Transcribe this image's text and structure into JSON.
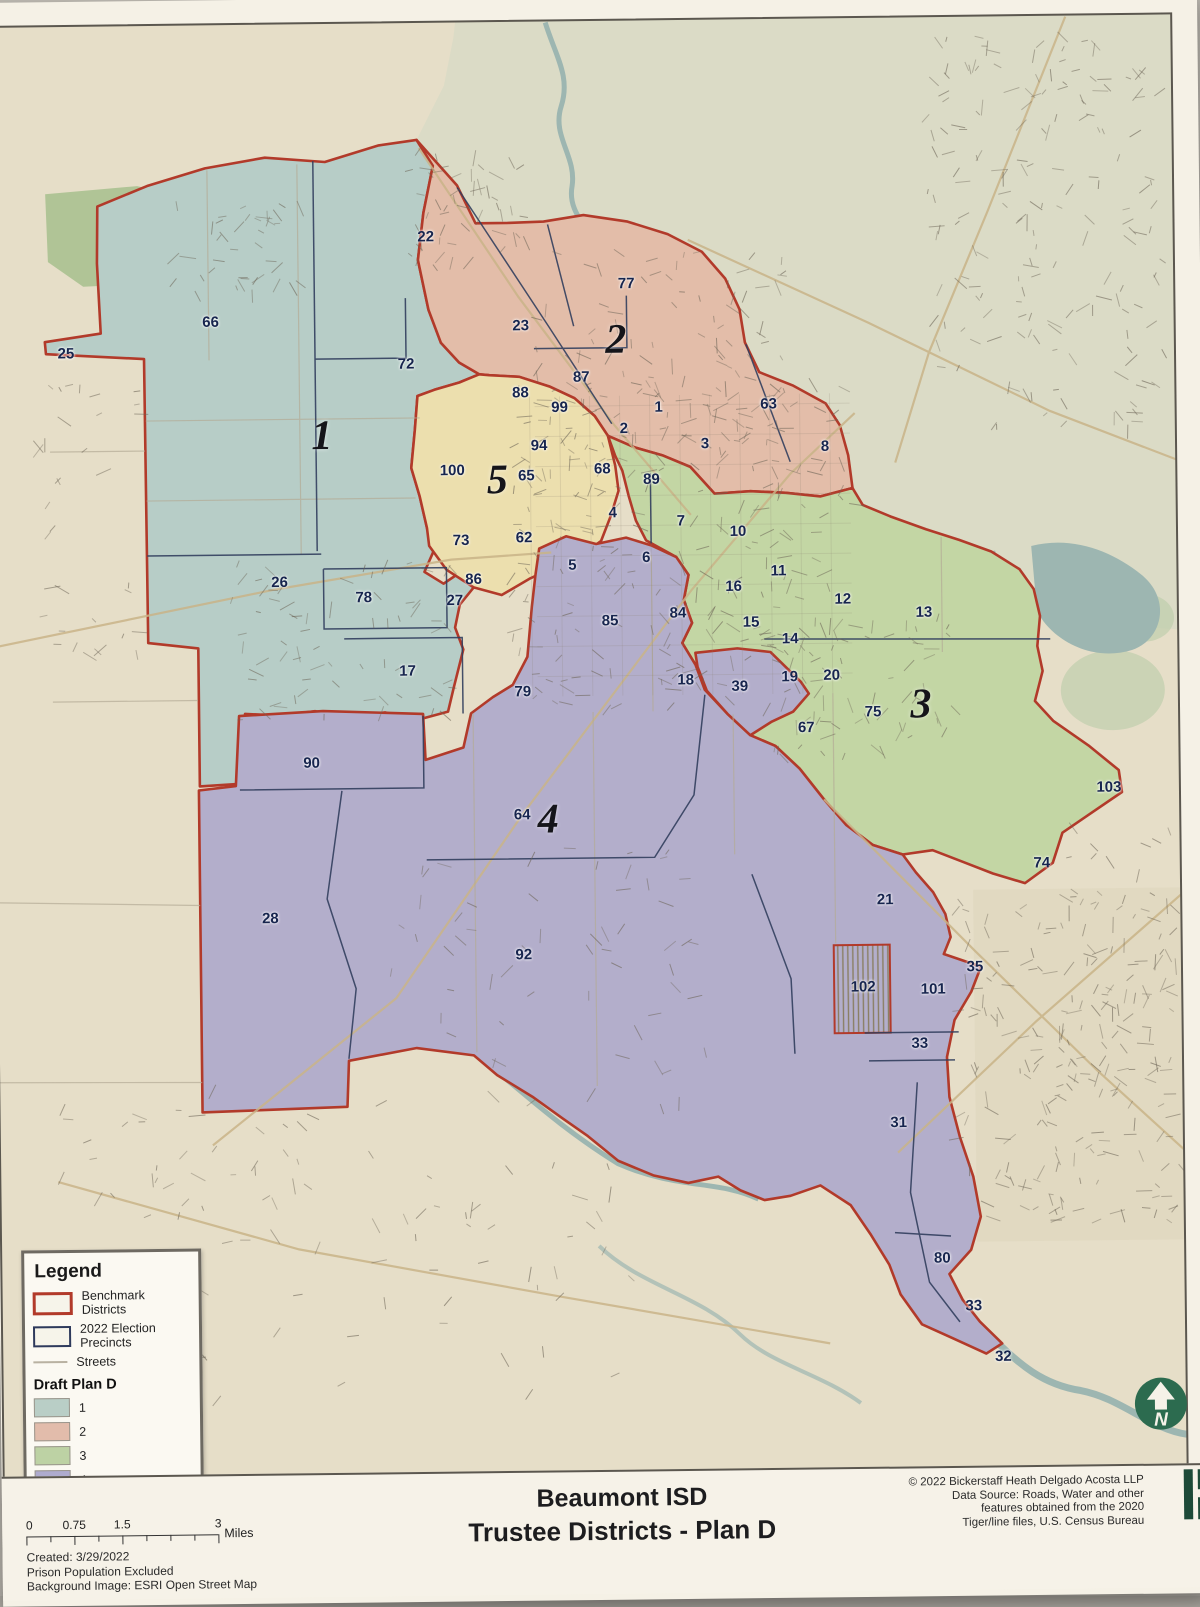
{
  "title": {
    "line1": "Beaumont ISD",
    "line2": "Trustee Districts - Plan D"
  },
  "notes": [
    "Created: 3/29/2022",
    "Prison Population Excluded",
    "Background Image: ESRI Open Street Map"
  ],
  "credits": [
    "© 2022 Bickerstaff Heath Delgado Acosta LLP",
    "Data Source: Roads, Water and other",
    "features obtained from the 2020",
    "Tiger/line files, U.S. Census Bureau"
  ],
  "scalebar": {
    "ticks": [
      "0",
      "0.75",
      "1.5",
      "3"
    ],
    "unit": "Miles"
  },
  "north_arrow": {
    "letter": "N"
  },
  "legend": {
    "title": "Legend",
    "items": [
      {
        "label": "Benchmark Districts",
        "swatch": "benchmark-red-outline"
      },
      {
        "label": "2022 Election Precincts",
        "swatch": "precinct-navy-outline"
      },
      {
        "label": "Streets",
        "swatch": "street-line"
      }
    ],
    "plan": {
      "title": "Draft Plan D",
      "classes": [
        {
          "label": "1",
          "color": "#b9cec6"
        },
        {
          "label": "2",
          "color": "#e2bcab"
        },
        {
          "label": "3",
          "color": "#bdd2a4"
        },
        {
          "label": "4",
          "color": "#aeabce"
        },
        {
          "label": "5",
          "color": "#e4e6cf"
        }
      ]
    }
  },
  "map": {
    "colors": {
      "benchmark_line": "#b23a2a",
      "precinct_line": "#323f5e",
      "background": "#e6dec8",
      "rural_background": "#d8dac6",
      "water": "#9db6b1",
      "district_fills": {
        "1": "#b7cdc7",
        "2": "#e3bda9",
        "3": "#c3d6a4",
        "4": "#b3aecb",
        "5": "#ecdfae"
      }
    },
    "district_labels": [
      {
        "num": "1",
        "x": 332,
        "y": 437
      },
      {
        "num": "2",
        "x": 627,
        "y": 344
      },
      {
        "num": "3",
        "x": 928,
        "y": 712
      },
      {
        "num": "4",
        "x": 554,
        "y": 823
      },
      {
        "num": "5",
        "x": 507,
        "y": 483
      }
    ],
    "precinct_labels": [
      {
        "num": "22",
        "x": 438,
        "y": 239
      },
      {
        "num": "66",
        "x": 222,
        "y": 322
      },
      {
        "num": "77",
        "x": 638,
        "y": 288
      },
      {
        "num": "25",
        "x": 77,
        "y": 352
      },
      {
        "num": "23",
        "x": 532,
        "y": 329
      },
      {
        "num": "72",
        "x": 417,
        "y": 366
      },
      {
        "num": "87",
        "x": 592,
        "y": 381
      },
      {
        "num": "88",
        "x": 531,
        "y": 396
      },
      {
        "num": "99",
        "x": 570,
        "y": 411
      },
      {
        "num": "63",
        "x": 779,
        "y": 410
      },
      {
        "num": "1",
        "x": 669,
        "y": 412
      },
      {
        "num": "2",
        "x": 634,
        "y": 433
      },
      {
        "num": "94",
        "x": 549,
        "y": 449
      },
      {
        "num": "3",
        "x": 715,
        "y": 449
      },
      {
        "num": "8",
        "x": 835,
        "y": 453
      },
      {
        "num": "100",
        "x": 462,
        "y": 473
      },
      {
        "num": "65",
        "x": 536,
        "y": 479
      },
      {
        "num": "68",
        "x": 612,
        "y": 473
      },
      {
        "num": "89",
        "x": 661,
        "y": 484
      },
      {
        "num": "4",
        "x": 622,
        "y": 517
      },
      {
        "num": "7",
        "x": 690,
        "y": 526
      },
      {
        "num": "73",
        "x": 470,
        "y": 543
      },
      {
        "num": "62",
        "x": 533,
        "y": 541
      },
      {
        "num": "10",
        "x": 747,
        "y": 537
      },
      {
        "num": "5",
        "x": 581,
        "y": 569
      },
      {
        "num": "6",
        "x": 655,
        "y": 562
      },
      {
        "num": "11",
        "x": 787,
        "y": 577
      },
      {
        "num": "26",
        "x": 288,
        "y": 583
      },
      {
        "num": "78",
        "x": 372,
        "y": 599
      },
      {
        "num": "86",
        "x": 482,
        "y": 582
      },
      {
        "num": "16",
        "x": 742,
        "y": 592
      },
      {
        "num": "12",
        "x": 851,
        "y": 606
      },
      {
        "num": "27",
        "x": 463,
        "y": 603
      },
      {
        "num": "13",
        "x": 932,
        "y": 620
      },
      {
        "num": "84",
        "x": 686,
        "y": 618
      },
      {
        "num": "85",
        "x": 618,
        "y": 625
      },
      {
        "num": "15",
        "x": 759,
        "y": 628
      },
      {
        "num": "14",
        "x": 798,
        "y": 645
      },
      {
        "num": "17",
        "x": 415,
        "y": 673
      },
      {
        "num": "18",
        "x": 693,
        "y": 685
      },
      {
        "num": "39",
        "x": 747,
        "y": 692
      },
      {
        "num": "19",
        "x": 797,
        "y": 683
      },
      {
        "num": "20",
        "x": 839,
        "y": 682
      },
      {
        "num": "75",
        "x": 880,
        "y": 719
      },
      {
        "num": "67",
        "x": 813,
        "y": 734
      },
      {
        "num": "79",
        "x": 530,
        "y": 695
      },
      {
        "num": "90",
        "x": 318,
        "y": 764
      },
      {
        "num": "64",
        "x": 528,
        "y": 818
      },
      {
        "num": "103",
        "x": 1115,
        "y": 797
      },
      {
        "num": "74",
        "x": 1047,
        "y": 872
      },
      {
        "num": "28",
        "x": 275,
        "y": 919
      },
      {
        "num": "21",
        "x": 890,
        "y": 907
      },
      {
        "num": "92",
        "x": 528,
        "y": 958
      },
      {
        "num": "35",
        "x": 979,
        "y": 975
      },
      {
        "num": "102",
        "x": 867,
        "y": 994
      },
      {
        "num": "101",
        "x": 937,
        "y": 997
      },
      {
        "num": "33",
        "x": 923,
        "y": 1051
      },
      {
        "num": "31",
        "x": 901,
        "y": 1130
      },
      {
        "num": "80",
        "x": 943,
        "y": 1266
      },
      {
        "num": "33",
        "x": 974,
        "y": 1314
      },
      {
        "num": "32",
        "x": 1003,
        "y": 1365
      }
    ]
  }
}
